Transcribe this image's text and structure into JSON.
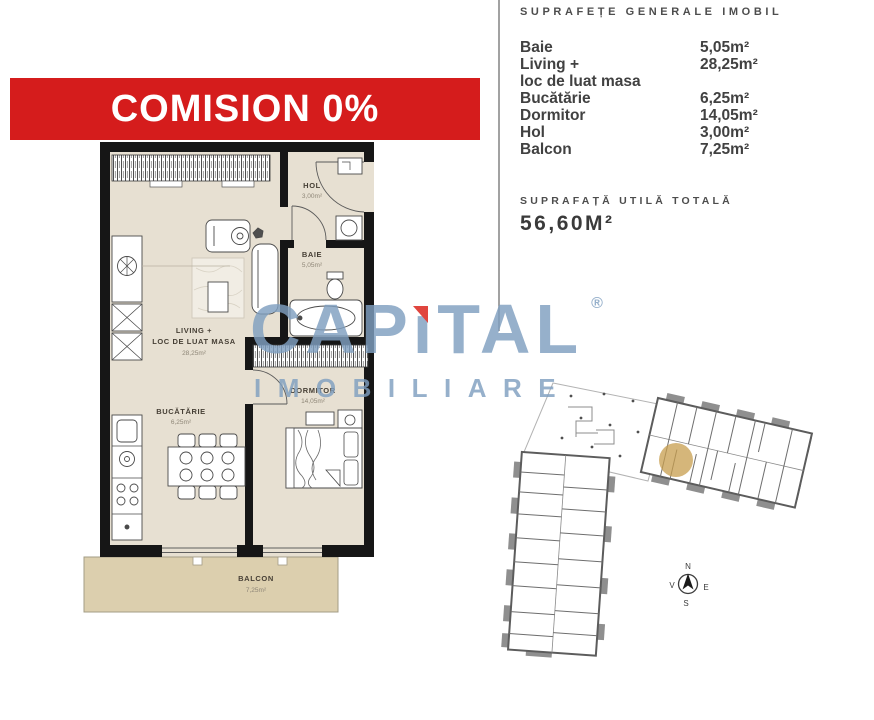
{
  "banner": {
    "text": "COMISION 0%"
  },
  "floor_plan": {
    "rooms": {
      "hol": {
        "name": "HOL",
        "area": "3,00m²"
      },
      "baie": {
        "name": "BAIE",
        "area": "5,05m²"
      },
      "living": {
        "name_line1": "LIVING +",
        "name_line2": "LOC DE LUAT MASA",
        "area": "28,25m²"
      },
      "bucatarie": {
        "name": "BUCĂTĂRIE",
        "area": "6,25m²"
      },
      "dormitor": {
        "name": "DORMITOR",
        "area": "14,05m²"
      },
      "balcon": {
        "name": "BALCON",
        "area": "7,25m²"
      }
    }
  },
  "areas_panel": {
    "title": "SUPRAFEȚE GENERALE IMOBIL",
    "rows": [
      {
        "label": "Baie",
        "value": "5,05m²"
      },
      {
        "label": "Living +",
        "value": "28,25m²"
      },
      {
        "label": "loc de luat masa",
        "value": ""
      },
      {
        "label": "Bucătărie",
        "value": "6,25m²"
      },
      {
        "label": "Dormitor",
        "value": "14,05m²"
      },
      {
        "label": "Hol",
        "value": "3,00m²"
      },
      {
        "label": "Balcon",
        "value": "7,25m²"
      }
    ],
    "total_label": "SUPRAFAȚĂ UTILĂ TOTALĂ",
    "total_value": "56,60M²"
  },
  "watermark": {
    "brand_part1": "CAP",
    "brand_i": "ı",
    "brand_part2": "TAL",
    "registered": "®",
    "subtitle": "IMOBILIARE"
  },
  "site_plan": {
    "compass": {
      "north": "N",
      "south": "S",
      "east": "E",
      "west": "V"
    }
  },
  "colors": {
    "banner_bg": "#d51c1c",
    "floor": "#e7e0d2",
    "balcony": "#dccfae",
    "wall": "#161616",
    "watermark_blue": "#7f9fc0",
    "accent_red": "#e0453e",
    "highlight_gold": "#c79e4e"
  }
}
